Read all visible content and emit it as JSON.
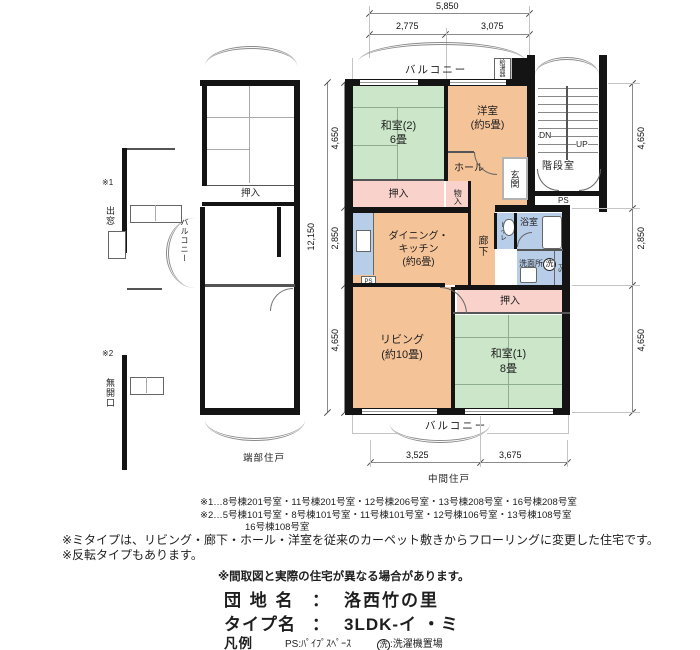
{
  "dims": {
    "top_total": "5,850",
    "top_seg1": "2,775",
    "top_seg2": "3,075",
    "left_total": "12,150",
    "left_seg1": "4,650",
    "left_seg2": "2,850",
    "left_seg3": "4,650",
    "right_seg1": "4,650",
    "right_seg2": "2,850",
    "right_seg3": "4,650",
    "bottom_seg1": "3,525",
    "bottom_seg2": "3,675"
  },
  "main_plan": {
    "balcony_top": "バルコニー",
    "water_heater": "給湯器",
    "washitsu2": "和室(2)\n6畳",
    "yoshitsu": "洋室\n(約5畳)",
    "hall": "ホール",
    "genkan": "玄関",
    "oshiire_top": "押入",
    "monoire": "物入",
    "dk": "ダイニング・\nキッチン\n(約6畳)",
    "rouka": "廊下",
    "toire": "トイレ",
    "yokushitsu": "浴室",
    "senmenjo": "洗面所",
    "wash_symbol": "洗",
    "ps_small": "PS",
    "ps_side": "PS",
    "ps_stair": "PS",
    "oshiire_bottom": "押入",
    "living": "リビング\n(約10畳)",
    "washitsu1": "和室(1)\n8畳",
    "balcony_bottom": "バルコニー",
    "kaidan": "階段室",
    "dn": "DN",
    "up": "UP",
    "caption": "中間住戸"
  },
  "left_plan": {
    "mark1": "※1",
    "demado": "出窓",
    "mark2": "※2",
    "mukaikou": "無開口",
    "balcony": "バルコニー",
    "oshiire": "押入",
    "caption": "端部住戸"
  },
  "notes": {
    "ref1": "※1…8号棟201号室・11号棟201号室・12号棟206号室・13号棟208号室・16号棟208号室",
    "ref2": "※2…5号棟101号室・8号棟101号室・11号棟101号室・12号棟106号室・13号棟108号室",
    "ref2b": "16号棟108号室",
    "mi_type": "※ミタイプは、リビング・廊下・ホール・洋室を従来のカーペット敷きからフローリングに変更した住宅です。",
    "reverse": "※反転タイプもあります。"
  },
  "title_block": {
    "disclaimer": "※間取図と実際の住宅が異なる場合があります。",
    "estate_label": "団 地 名",
    "separator": "：",
    "estate_name": "洛西竹の里",
    "type_label": "タイプ名",
    "type_name": "3LDK-イ ・ミ",
    "legend_label": "凡例",
    "legend_ps": "PS:ﾊﾟｲﾌﾟｽﾍﾟｰｽ",
    "legend_wash_symbol": "洗",
    "legend_wash_text": ":洗濯機置場"
  },
  "colors": {
    "flooring": "#F5C398",
    "tatami": "#CBE6C8",
    "closet": "#F8D2CB",
    "wet_area": "#B8CDE8",
    "wall": "#141414"
  }
}
